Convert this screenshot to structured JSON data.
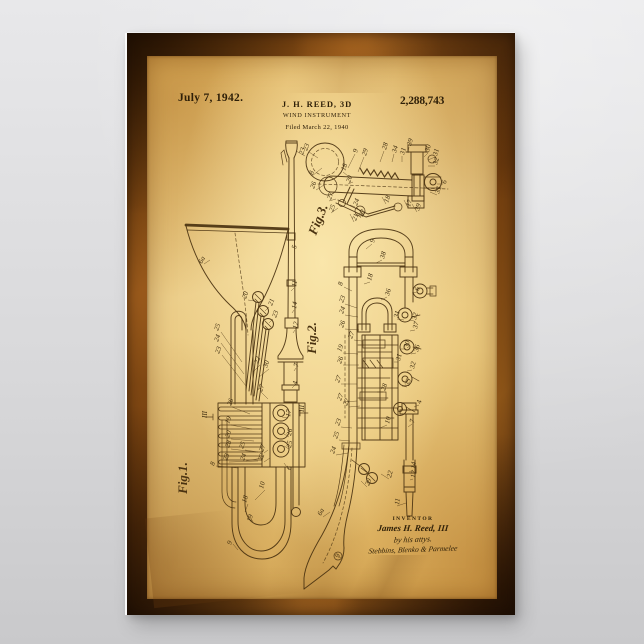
{
  "colors": {
    "bg-top": "#e8e8ea",
    "bg-mid": "#d9d9db",
    "bg-bot": "#c9c9cb",
    "frame": "#6e3c10",
    "parchment": "#e9c470",
    "ink": "#4a3210",
    "ink-num": "#3f2d10",
    "edge-light": "#fafafa"
  },
  "poster": {
    "header": {
      "date": "July 7, 1942.",
      "inventor_line": "J. H. REED, 3D",
      "patent_number": "2,288,743",
      "title": "WIND INSTRUMENT",
      "filed_line": "Filed March 22, 1940"
    },
    "figures": [
      {
        "label": "Fig.1."
      },
      {
        "label": "Fig.2."
      },
      {
        "label": "Fig.3."
      }
    ],
    "signature": {
      "caption": "INVENTOR",
      "inventor_name": "James H. Reed, III",
      "attorney_line": "by his attys.",
      "firm_line": "Stebbins, Blenko & Parmelee"
    },
    "drawing": {
      "numerals": [
        [
          "6a",
          202,
          264,
          -62
        ],
        [
          "20",
          246,
          299,
          -70
        ],
        [
          "21",
          272,
          306,
          -70
        ],
        [
          "23",
          276,
          318,
          -70
        ],
        [
          "25",
          218,
          331,
          -70
        ],
        [
          "24",
          218,
          342,
          -70
        ],
        [
          "23",
          219,
          354,
          -70
        ],
        [
          "23",
          303,
          155,
          -72
        ],
        [
          "8",
          313,
          175,
          -72
        ],
        [
          "5",
          296,
          249,
          -78
        ],
        [
          "11",
          296,
          287,
          -80
        ],
        [
          "14",
          296,
          309,
          -80
        ],
        [
          "12",
          297,
          329,
          -80
        ],
        [
          "7",
          298,
          367,
          -80
        ],
        [
          "22",
          258,
          364,
          -70
        ],
        [
          "30",
          267,
          368,
          -70
        ],
        [
          "4",
          297,
          385,
          -80
        ],
        [
          "27",
          262,
          392,
          -72
        ],
        [
          "17",
          290,
          417,
          -80
        ],
        [
          "III",
          207,
          418,
          -90
        ],
        [
          "III",
          304,
          412,
          -90
        ],
        [
          "26",
          231,
          406,
          -70
        ],
        [
          "19",
          229,
          424,
          -70
        ],
        [
          "20",
          229,
          438,
          -70
        ],
        [
          "28",
          229,
          448,
          -70
        ],
        [
          "23",
          227,
          461,
          -70
        ],
        [
          "25",
          243,
          449,
          -70
        ],
        [
          "24",
          244,
          461,
          -70
        ],
        [
          "22",
          262,
          461,
          -70
        ],
        [
          "27",
          263,
          452,
          -70
        ],
        [
          "8",
          214,
          466,
          -70
        ],
        [
          "6",
          291,
          470,
          -80
        ],
        [
          "26",
          291,
          436,
          -80
        ],
        [
          "25",
          291,
          448,
          -80
        ],
        [
          "10",
          263,
          489,
          -74
        ],
        [
          "18",
          246,
          503,
          -74
        ],
        [
          "19",
          251,
          522,
          -74
        ],
        [
          "9",
          231,
          545,
          -70
        ],
        [
          "9",
          374,
          243,
          -74
        ],
        [
          "38",
          384,
          259,
          -74
        ],
        [
          "8",
          342,
          286,
          -74
        ],
        [
          "18",
          371,
          281,
          -74
        ],
        [
          "6",
          419,
          291,
          -80
        ],
        [
          "36",
          389,
          296,
          -74
        ],
        [
          "23",
          343,
          303,
          -70
        ],
        [
          "24",
          343,
          314,
          -70
        ],
        [
          "26",
          343,
          328,
          -70
        ],
        [
          "27",
          352,
          339,
          -70
        ],
        [
          "19",
          341,
          352,
          -70
        ],
        [
          "26",
          341,
          364,
          -70
        ],
        [
          "27",
          339,
          383,
          -70
        ],
        [
          "27",
          341,
          401,
          -70
        ],
        [
          "22",
          347,
          406,
          -70
        ],
        [
          "31",
          398,
          318,
          -76
        ],
        [
          "32",
          416,
          320,
          -76
        ],
        [
          "37",
          417,
          329,
          -76
        ],
        [
          "30",
          408,
          348,
          -76
        ],
        [
          "36",
          418,
          352,
          -76
        ],
        [
          "31",
          400,
          361,
          -76
        ],
        [
          "32",
          414,
          369,
          -76
        ],
        [
          "35",
          409,
          386,
          -76
        ],
        [
          "28",
          385,
          391,
          -72
        ],
        [
          "29",
          369,
          486,
          -70
        ],
        [
          "23",
          339,
          426,
          -70
        ],
        [
          "25",
          337,
          439,
          -70
        ],
        [
          "24",
          334,
          454,
          -70
        ],
        [
          "22",
          391,
          478,
          -76
        ],
        [
          "10",
          389,
          424,
          -76
        ],
        [
          "7",
          414,
          423,
          -80
        ],
        [
          "4",
          421,
          404,
          -80
        ],
        [
          "14",
          415,
          469,
          -82
        ],
        [
          "12",
          415,
          478,
          -82
        ],
        [
          "11",
          399,
          505,
          -82
        ],
        [
          "6a",
          321,
          516,
          -62
        ],
        [
          "9",
          339,
          558,
          -70
        ],
        [
          "23",
          307,
          151,
          -70
        ],
        [
          "9",
          357,
          153,
          -74
        ],
        [
          "29",
          366,
          156,
          -74
        ],
        [
          "28",
          386,
          150,
          -74
        ],
        [
          "34",
          396,
          153,
          -74
        ],
        [
          "31",
          404,
          155,
          -74
        ],
        [
          "39",
          411,
          146,
          -74
        ],
        [
          "30",
          429,
          152,
          -74
        ],
        [
          "31",
          437,
          156,
          -74
        ],
        [
          "32",
          437,
          165,
          -74
        ],
        [
          "6",
          446,
          184,
          -80
        ],
        [
          "33",
          439,
          194,
          -74
        ],
        [
          "17",
          410,
          207,
          -74
        ],
        [
          "39",
          419,
          211,
          -74
        ],
        [
          "18",
          388,
          203,
          -70
        ],
        [
          "26",
          314,
          189,
          -70
        ],
        [
          "18",
          345,
          171,
          -70
        ],
        [
          "20",
          350,
          183,
          -70
        ],
        [
          "27",
          331,
          200,
          -70
        ],
        [
          "25",
          333,
          212,
          -70
        ],
        [
          "24",
          357,
          206,
          -70
        ],
        [
          "21",
          356,
          221,
          -70
        ],
        [
          "22",
          363,
          217,
          -70
        ]
      ]
    }
  }
}
